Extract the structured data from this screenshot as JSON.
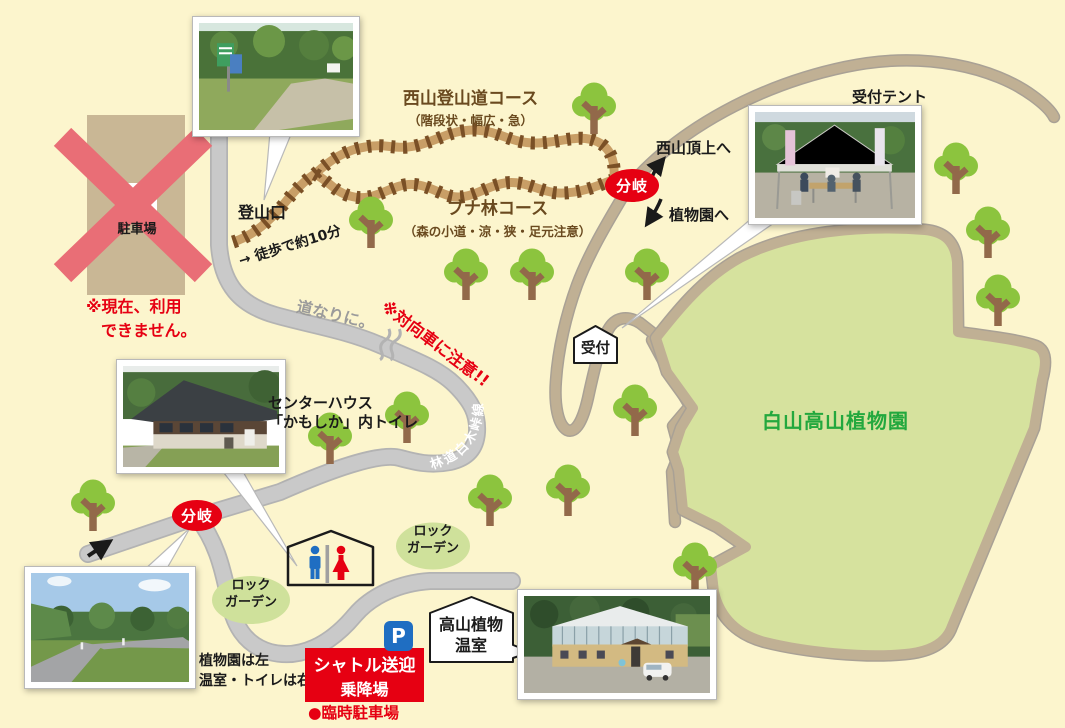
{
  "parking_closed": {
    "p_label": "P",
    "name": "駐車場",
    "notice_line1": "※現在、利用",
    "notice_line2": "できません。"
  },
  "trailhead": {
    "label": "登山口",
    "walk_time": "→ 徒歩で約10分"
  },
  "courses": {
    "nishiyama": {
      "title": "西山登山道コース",
      "subtitle": "（階段状・幅広・急）"
    },
    "buna": {
      "title": "ブナ林コース",
      "subtitle": "（森の小道・涼・狭・足元注意）"
    }
  },
  "junctions": {
    "top": "分岐",
    "bottom": "分岐"
  },
  "signs": {
    "to_summit": "西山頂上へ",
    "to_garden": "植物園へ"
  },
  "reception": {
    "tent_label": "受付テント",
    "booth_label": "受付"
  },
  "garden": {
    "name": "白山高山植物園"
  },
  "road_notes": {
    "follow": "道なりに。",
    "oncoming": "※対向車に注意!!",
    "forest_road_name": "林道白木峠線"
  },
  "center_house": {
    "line1": "センターハウス",
    "line2": "「かもしか」内トイレ"
  },
  "rock_garden": {
    "line1": "ロック",
    "line2": "ガーデン"
  },
  "greenhouse": {
    "line1": "高山植物",
    "line2": "温室"
  },
  "shuttle": {
    "p_label": "P",
    "line1": "シャトル送迎",
    "line2": "乗降場",
    "temp_parking": "●臨時駐車場"
  },
  "directions": {
    "line1": "植物園は左",
    "line2": "温室・トイレは右"
  },
  "photos": {
    "trailhead": "trailhead-photo",
    "reception_tent": "reception-tent-photo",
    "center_house": "center-house-photo",
    "road_fork": "road-fork-photo",
    "greenhouse": "greenhouse-photo"
  },
  "colors": {
    "background": "#fcf5cd",
    "road_gray": "#c9c9c9",
    "road_edge": "#b3b3b3",
    "path_tan": "#c0b094",
    "path_edge": "#a9a195",
    "garden_green": "#d6e29e",
    "tree_green": "#8cc43e",
    "trail_dark": "#7a5026",
    "trail_light": "#c89e66",
    "accent_red": "#e60012",
    "p_blue": "#1f6ec2",
    "rock_green": "#cfe19b",
    "x_pink": "#e96e76"
  }
}
